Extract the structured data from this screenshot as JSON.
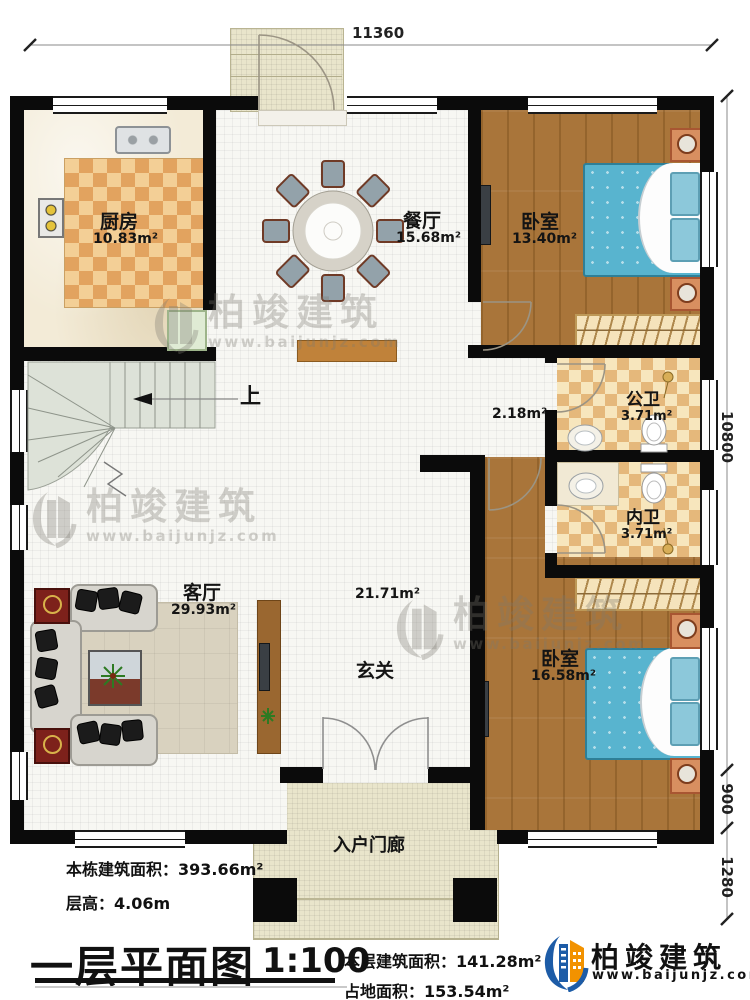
{
  "colors": {
    "wall": "#0b0b0b",
    "wood_floor": "#a9753a",
    "bed_blue": "#58b4cf",
    "kitchen_mat": "#e2a35f",
    "bath_tile": "#e5b87b",
    "stair": "#dde2d8",
    "porch": "#e9e5cb",
    "logo_blue": "#1d5ca7",
    "logo_orange": "#f29200"
  },
  "dimensions": {
    "top_width": "11360",
    "right_height_main": "10800",
    "right_height_mid": "900",
    "right_height_bottom": "1280"
  },
  "rooms": {
    "kitchen": {
      "name": "厨房",
      "area": "10.83m²"
    },
    "dining": {
      "name": "餐厅",
      "area": "15.68m²"
    },
    "bedroom_top": {
      "name": "卧室",
      "area": "13.40m²"
    },
    "public_bath": {
      "name": "公卫",
      "area": "3.71m²"
    },
    "inner_bath": {
      "name": "内卫",
      "area": "3.71m²"
    },
    "living": {
      "name": "客厅",
      "area": "29.93m²"
    },
    "bedroom_bottom": {
      "name": "卧室",
      "area": "16.58m²"
    },
    "foyer": {
      "name": "玄关",
      "area": "21.71m²"
    },
    "hall": {
      "area": "2.18m²"
    },
    "entry_porch": {
      "name": "入户门廊"
    }
  },
  "stairs": {
    "up_label": "上"
  },
  "title_block": {
    "building_total_area": "本栋建筑面积：393.66m²",
    "floor_height": "层高：4.06m",
    "plan_title": "一层平面图",
    "scale": "1:100",
    "floor_area": "本层建筑面积：141.28m²",
    "land_area": "占地面积：153.54m²"
  },
  "brand": {
    "name": "柏竣建筑",
    "url": "www.baijunjz.com"
  }
}
